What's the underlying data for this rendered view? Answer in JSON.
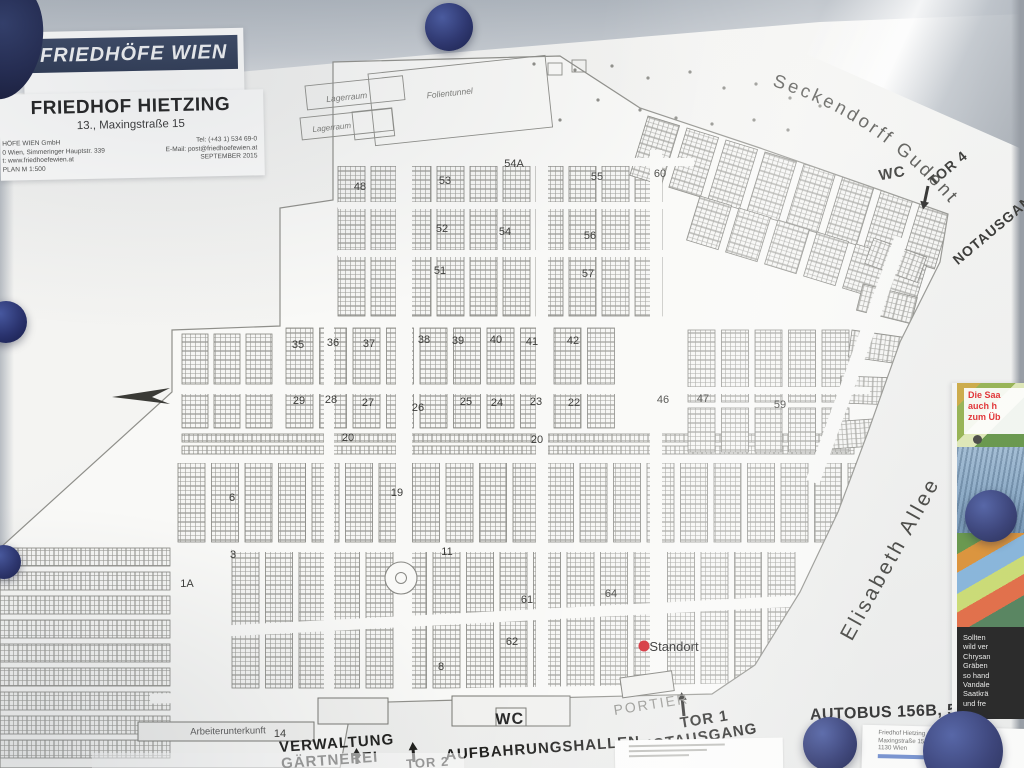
{
  "photo": {
    "magnet_color": "#1d2455",
    "board_color": "#f2f2f0",
    "standort_color": "#cf1520"
  },
  "logo_card": {
    "brand": "FRIEDHÖFE WIEN"
  },
  "title_card": {
    "title": "FRIEDHOF HIETZING",
    "subtitle": "13., Maxingstraße 15",
    "info_left": [
      "HÖFE WIEN GmbH",
      "0 Wien, Simmeringer Hauptstr. 339",
      "t: www.friedhoefewien.at",
      "PLAN   M 1:500"
    ],
    "info_right": [
      "Tel: (+43 1) 534 69-0",
      "E-Mail: post@friedhoefewien.at",
      "SEPTEMBER        2015"
    ]
  },
  "map": {
    "street_seckendorff": "Seckendorff Gudent Weg",
    "labels": [
      {
        "text": "Elisabeth  Allee",
        "x": 896,
        "y": 562,
        "rot": -61,
        "size": 21,
        "weight": 400,
        "color": "#3c3c38",
        "ls": 3
      },
      {
        "text": "WC",
        "x": 893,
        "y": 178,
        "rot": -10,
        "size": 15,
        "weight": 700,
        "color": "#2b2b28",
        "ls": 1
      },
      {
        "text": "TOR 4",
        "x": 951,
        "y": 172,
        "rot": -40,
        "size": 14,
        "weight": 700,
        "color": "#2b2b28",
        "ls": 1
      },
      {
        "text": "NOTAUSGANG",
        "x": 1000,
        "y": 230,
        "rot": -40,
        "size": 14,
        "weight": 700,
        "color": "#2b2b28",
        "ls": 1
      },
      {
        "text": "WC",
        "x": 510,
        "y": 724,
        "rot": -2,
        "size": 16,
        "weight": 700,
        "color": "#222222",
        "ls": 1
      },
      {
        "text": "PORTIER",
        "x": 652,
        "y": 709,
        "rot": -9,
        "size": 14,
        "weight": 400,
        "color": "#8e8e8a",
        "ls": 2
      },
      {
        "text": "TOR 1",
        "x": 705,
        "y": 724,
        "rot": -9,
        "size": 15,
        "weight": 700,
        "color": "#1e1e1c",
        "ls": 1
      },
      {
        "text": "NOTAUSGANG",
        "x": 700,
        "y": 742,
        "rot": -9,
        "size": 15,
        "weight": 700,
        "color": "#1e1e1c",
        "ls": 1
      },
      {
        "text": "VERWALTUNG",
        "x": 337,
        "y": 748,
        "rot": -4,
        "size": 15,
        "weight": 700,
        "color": "#1e1e1c",
        "ls": 1
      },
      {
        "text": "GÄRTNEREI",
        "x": 330,
        "y": 765,
        "rot": -4,
        "size": 15,
        "weight": 700,
        "color": "#1e1e1c",
        "ls": 1
      },
      {
        "text": "TOR 2",
        "x": 428,
        "y": 767,
        "rot": -4,
        "size": 13,
        "weight": 700,
        "color": "#1e1e1c",
        "ls": 1
      },
      {
        "text": "AUFBAHRUNGSHALLEN",
        "x": 543,
        "y": 753,
        "rot": -4,
        "size": 15,
        "weight": 700,
        "color": "#1e1e1c",
        "ls": 1
      },
      {
        "text": "AUTOBUS 156B, 56B, 58B,",
        "x": 917,
        "y": 716,
        "rot": -2,
        "size": 16,
        "weight": 700,
        "color": "#242424",
        "ls": 0.5
      },
      {
        "text": "Arbeiterunterkunft",
        "x": 228,
        "y": 734,
        "rot": -1,
        "size": 9.5,
        "weight": 400,
        "color": "#555555",
        "ls": 0
      },
      {
        "text": "Lagerraum",
        "x": 347,
        "y": 100,
        "rot": -6,
        "size": 8.5,
        "weight": 400,
        "color": "#7a7a76",
        "ls": 0,
        "italic": true
      },
      {
        "text": "Lagerraum",
        "x": 332,
        "y": 130,
        "rot": -6,
        "size": 8,
        "weight": 400,
        "color": "#7a7a76",
        "ls": 0,
        "italic": true
      },
      {
        "text": "Folientunnel",
        "x": 450,
        "y": 96,
        "rot": -6,
        "size": 8.5,
        "weight": 400,
        "color": "#7a7a76",
        "ls": 0,
        "italic": true
      },
      {
        "text": "Standort",
        "x": 674,
        "y": 651,
        "rot": 0,
        "size": 13,
        "weight": 400,
        "color": "#111111",
        "ls": 0
      }
    ],
    "group_numbers": [
      {
        "n": "35",
        "x": 298,
        "y": 348
      },
      {
        "n": "36",
        "x": 333,
        "y": 346
      },
      {
        "n": "37",
        "x": 369,
        "y": 347
      },
      {
        "n": "38",
        "x": 424,
        "y": 343
      },
      {
        "n": "39",
        "x": 458,
        "y": 344
      },
      {
        "n": "40",
        "x": 496,
        "y": 343
      },
      {
        "n": "41",
        "x": 532,
        "y": 345
      },
      {
        "n": "42",
        "x": 573,
        "y": 344
      },
      {
        "n": "29",
        "x": 299,
        "y": 404
      },
      {
        "n": "28",
        "x": 331,
        "y": 403
      },
      {
        "n": "27",
        "x": 368,
        "y": 406
      },
      {
        "n": "26",
        "x": 418,
        "y": 411
      },
      {
        "n": "25",
        "x": 466,
        "y": 405
      },
      {
        "n": "24",
        "x": 497,
        "y": 406
      },
      {
        "n": "23",
        "x": 536,
        "y": 405
      },
      {
        "n": "22",
        "x": 574,
        "y": 406
      },
      {
        "n": "20",
        "x": 348,
        "y": 441
      },
      {
        "n": "20",
        "x": 537,
        "y": 443
      },
      {
        "n": "19",
        "x": 397,
        "y": 496
      },
      {
        "n": "6",
        "x": 232,
        "y": 501
      },
      {
        "n": "3",
        "x": 233,
        "y": 558
      },
      {
        "n": "1A",
        "x": 187,
        "y": 587
      },
      {
        "n": "11",
        "x": 447,
        "y": 555
      },
      {
        "n": "8",
        "x": 441,
        "y": 670
      },
      {
        "n": "61",
        "x": 527,
        "y": 603
      },
      {
        "n": "62",
        "x": 512,
        "y": 645
      },
      {
        "n": "64",
        "x": 611,
        "y": 597
      },
      {
        "n": "46",
        "x": 663,
        "y": 403
      },
      {
        "n": "47",
        "x": 703,
        "y": 402
      },
      {
        "n": "59",
        "x": 780,
        "y": 408
      },
      {
        "n": "48",
        "x": 360,
        "y": 190
      },
      {
        "n": "53",
        "x": 445,
        "y": 184
      },
      {
        "n": "54A",
        "x": 514,
        "y": 167
      },
      {
        "n": "55",
        "x": 597,
        "y": 180
      },
      {
        "n": "60",
        "x": 660,
        "y": 177
      },
      {
        "n": "52",
        "x": 442,
        "y": 232
      },
      {
        "n": "54",
        "x": 505,
        "y": 235
      },
      {
        "n": "56",
        "x": 590,
        "y": 239
      },
      {
        "n": "57",
        "x": 588,
        "y": 277
      },
      {
        "n": "51",
        "x": 440,
        "y": 274
      },
      {
        "n": "14",
        "x": 280,
        "y": 737
      }
    ]
  },
  "poster": {
    "top_lines": [
      "Die Saa",
      "auch h",
      "zum Üb"
    ],
    "panel_lines": [
      "Sollten",
      "wild ver",
      "Chrysan",
      "Gräben",
      "so hand",
      "Vandale",
      "",
      "Saatkrä",
      "und fre"
    ]
  },
  "addr_card": {
    "lines": [
      "Friedhof Hietzing",
      "Maxingstraße 15",
      "1130 Wien"
    ]
  }
}
